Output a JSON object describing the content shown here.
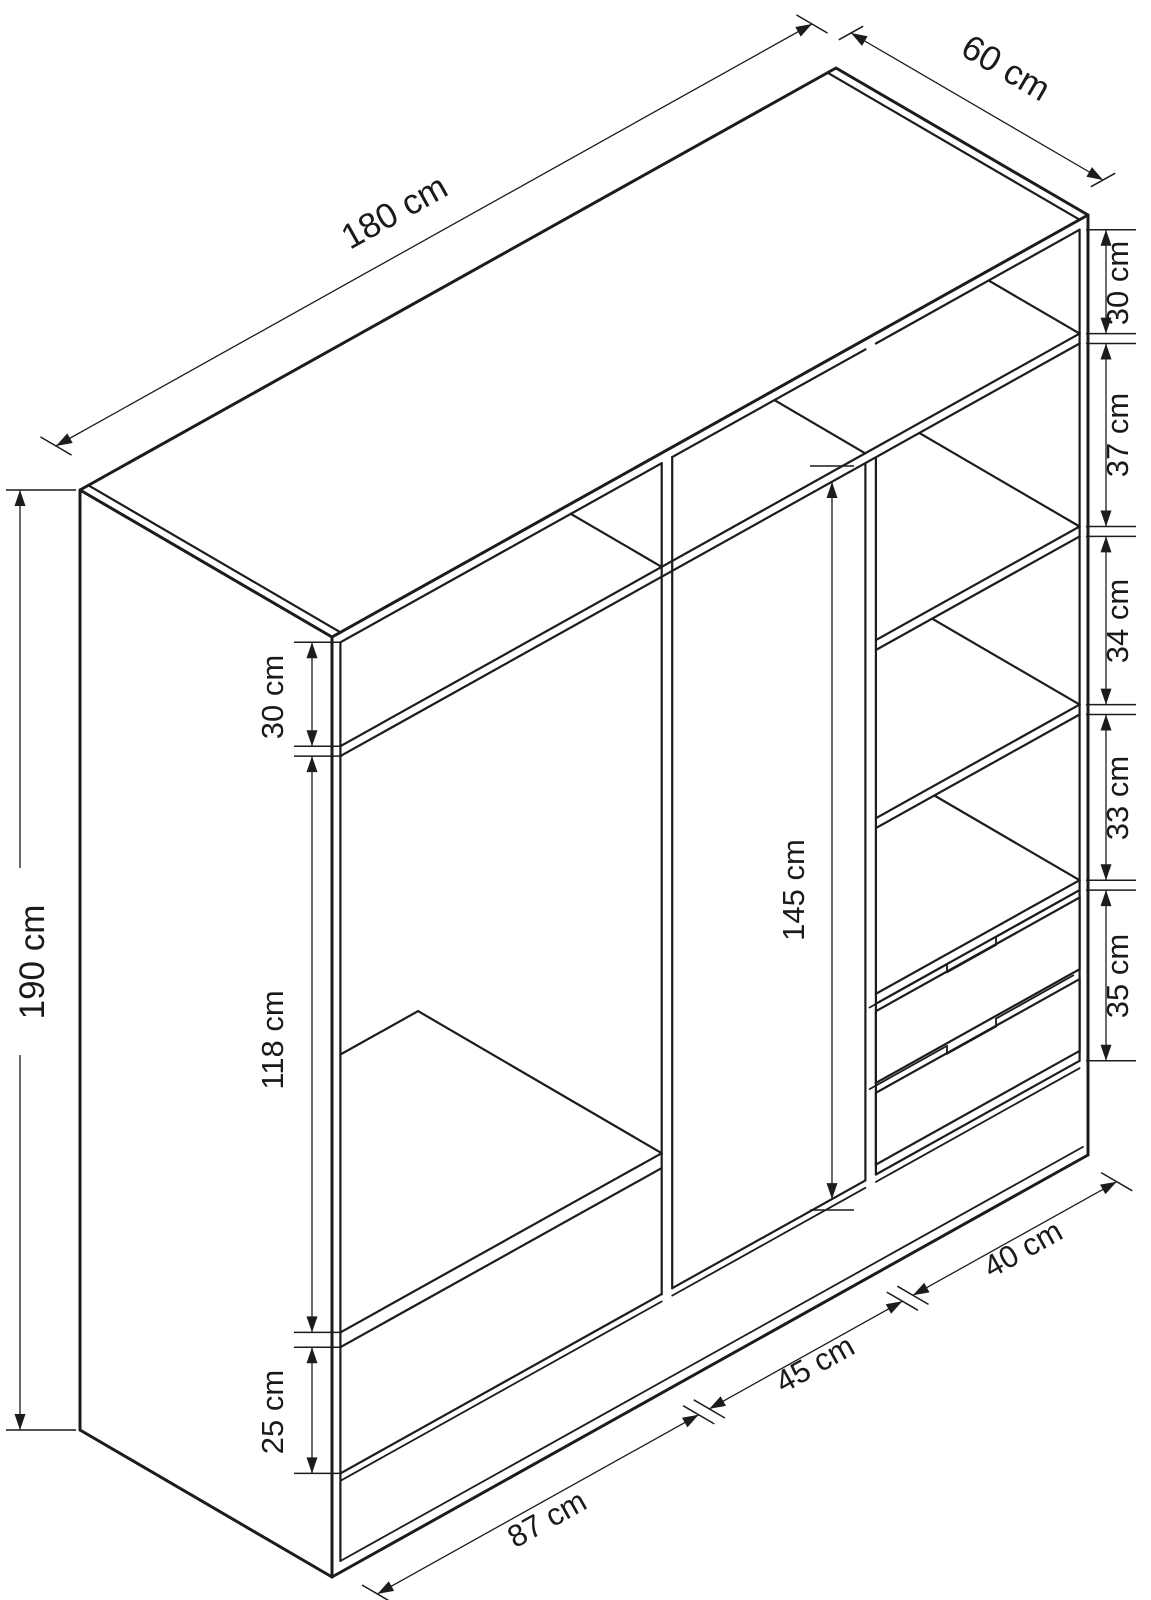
{
  "diagram": {
    "title": "Wardrobe interior dimensions — isometric line drawing",
    "type": "technical-drawing"
  },
  "colors": {
    "line": "#1c1c1c",
    "background": "#ffffff",
    "text": "#1a1a1a"
  },
  "dims": {
    "width": "180 cm",
    "depth": "60 cm",
    "height": "190 cm",
    "left_top_gap": "30 cm",
    "left_hanging": "118 cm",
    "left_bottom_gap": "25 cm",
    "middle_height": "145 cm",
    "right_gap_1": "30 cm",
    "right_gap_2": "37 cm",
    "right_gap_3": "34 cm",
    "right_gap_4": "33 cm",
    "right_gap_5": "35 cm",
    "section_left": "87 cm",
    "section_middle": "45 cm",
    "section_right": "40 cm"
  }
}
